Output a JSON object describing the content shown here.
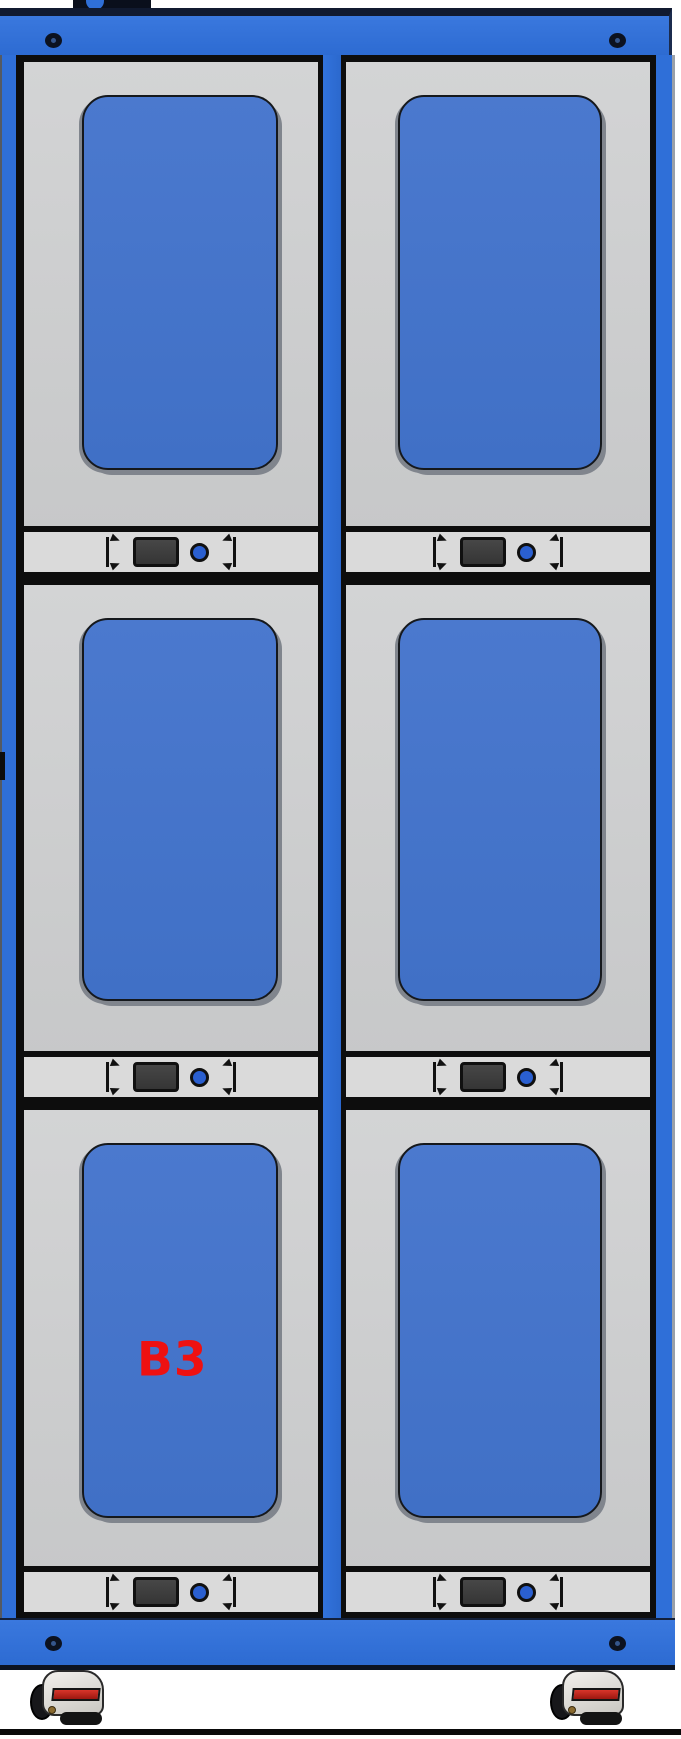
{
  "scene": {
    "description_label": "",
    "colors": {
      "frame_blue": "#2f6fd8",
      "panel_blue": "#4573c9",
      "door_gray": "#c9c9c9",
      "strip_gray": "#dadada",
      "label_red": "#ee1111",
      "background": "#ffffff"
    },
    "icons": {
      "screw": "screw-hole-icon",
      "led": "led-indicator-icon",
      "lcd": "lcd-display",
      "bracket": "corner-bracket-icon",
      "caster": "caster-wheel-icon"
    }
  },
  "cabinet": {
    "rows": 3,
    "columns": 2,
    "compartments": [
      {
        "id": "r1c1",
        "label": ""
      },
      {
        "id": "r1c2",
        "label": ""
      },
      {
        "id": "r2c1",
        "label": ""
      },
      {
        "id": "r2c2",
        "label": ""
      },
      {
        "id": "r3c1",
        "label": "B3"
      },
      {
        "id": "r3c2",
        "label": ""
      }
    ]
  }
}
